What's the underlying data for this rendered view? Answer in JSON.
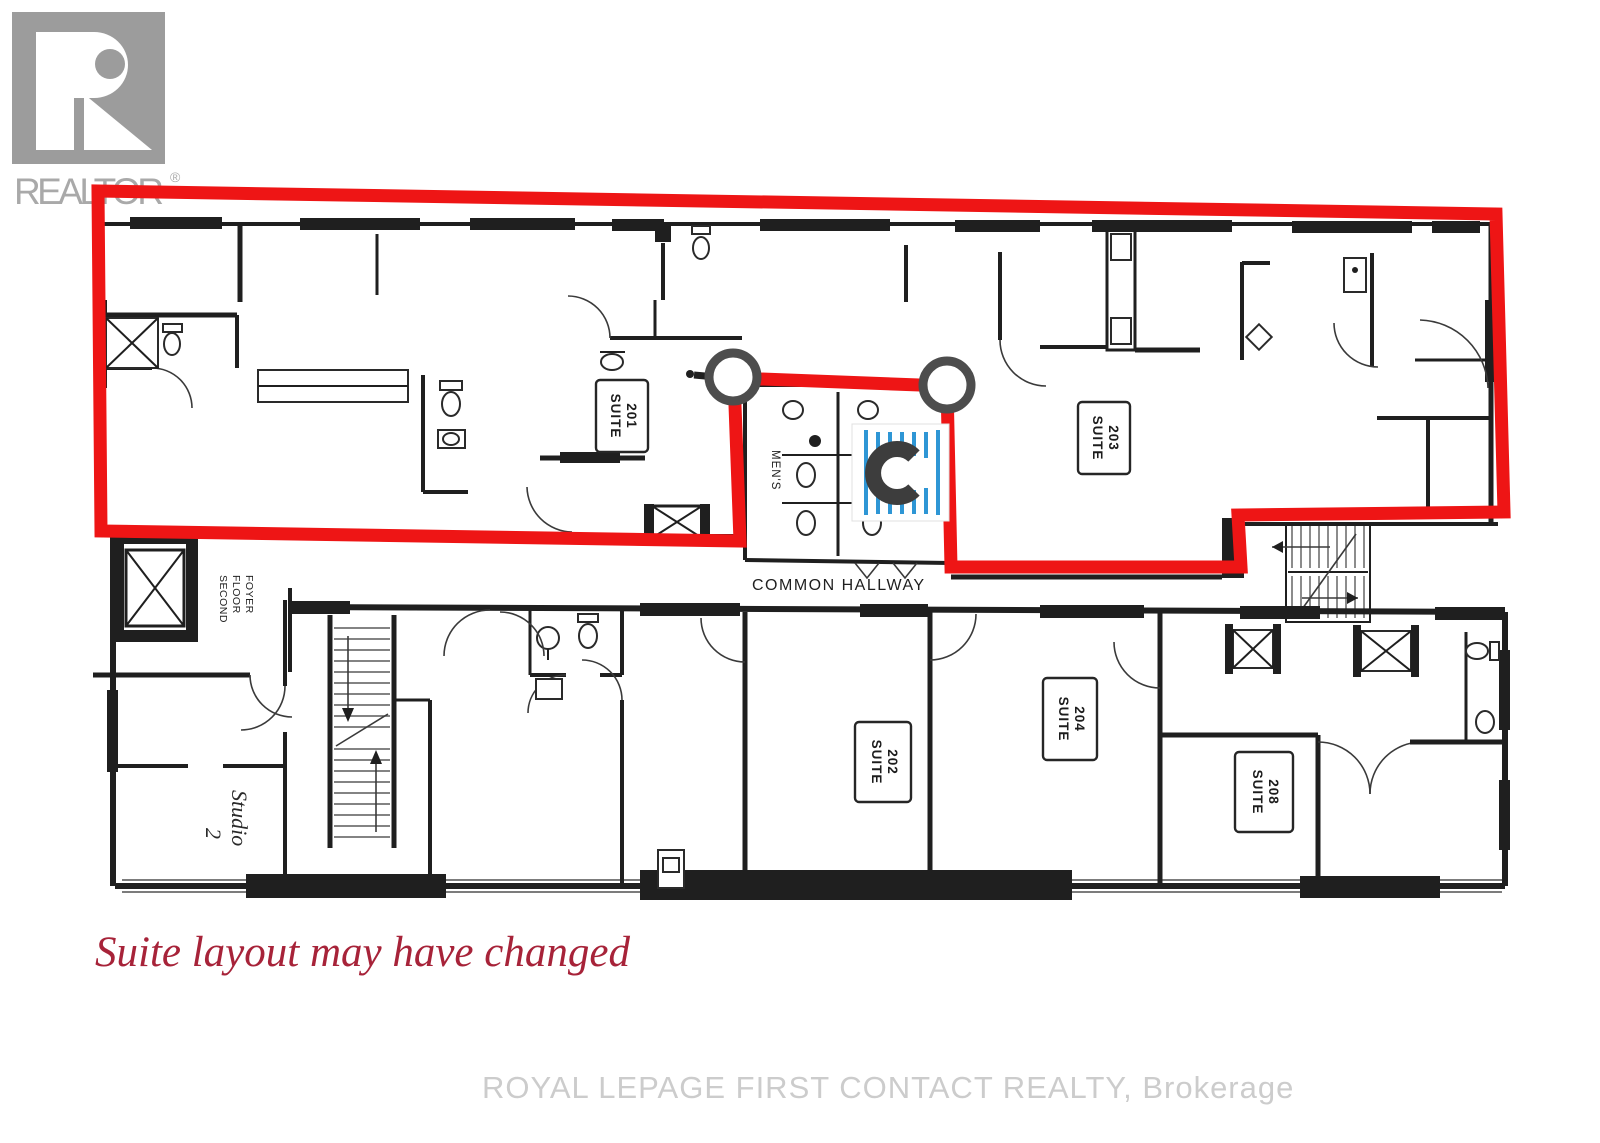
{
  "branding": {
    "logo_letter": "R",
    "logo_text": "REALTOR",
    "registered_mark": "®"
  },
  "suites": [
    {
      "label": "SUITE",
      "number": "201"
    },
    {
      "label": "SUITE",
      "number": "202"
    },
    {
      "label": "SUITE",
      "number": "203"
    },
    {
      "label": "SUITE",
      "number": "204"
    },
    {
      "label": "SUITE",
      "number": "208"
    }
  ],
  "areas": {
    "common_hallway": "COMMON HALLWAY",
    "mens_washroom": "MEN'S",
    "foyer_lines": [
      "SECOND",
      "FLOOR",
      "FOYER"
    ],
    "studio_label": "Studio",
    "studio_number": "2"
  },
  "annotations": {
    "disclaimer": "Suite layout may have changed",
    "watermark": "ROYAL LEPAGE FIRST CONTACT REALTY, Brokerage"
  },
  "colors": {
    "highlight_red": "#ee1515",
    "marker_gray": "#4d4d4d",
    "icon_blue": "#2e96d5",
    "disclaimer_red": "#a72339"
  }
}
